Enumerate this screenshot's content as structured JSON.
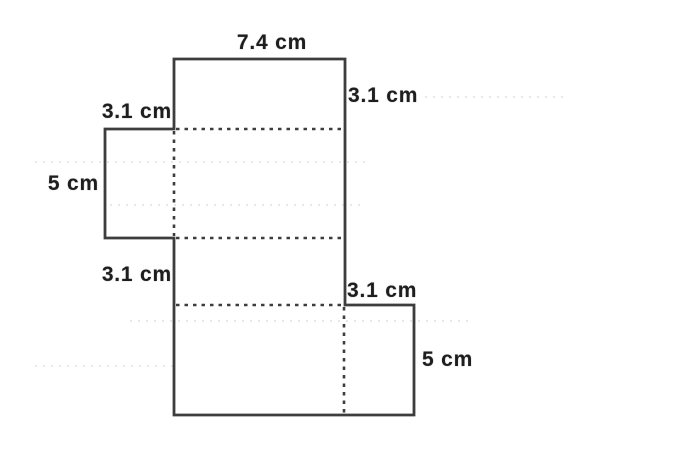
{
  "figure": {
    "labels": {
      "top_width": "7.4 cm",
      "top_face_height": "3.1 cm",
      "left_flap_width": "3.1 cm",
      "left_flap_height": "5 cm",
      "bottom_face_height": "3.1 cm",
      "right_flap_width": "3.1 cm",
      "right_flap_height": "5 cm"
    },
    "measurements": {
      "length_cm": 7.4,
      "depth_cm": 3.1,
      "height_cm": 5
    },
    "colors": {
      "outline": "#3d3d3d",
      "fold_line": "#3d3d3d",
      "text": "#1e1e1e",
      "background": "#ffffff",
      "faint_rule": "#d8d8d8"
    }
  }
}
